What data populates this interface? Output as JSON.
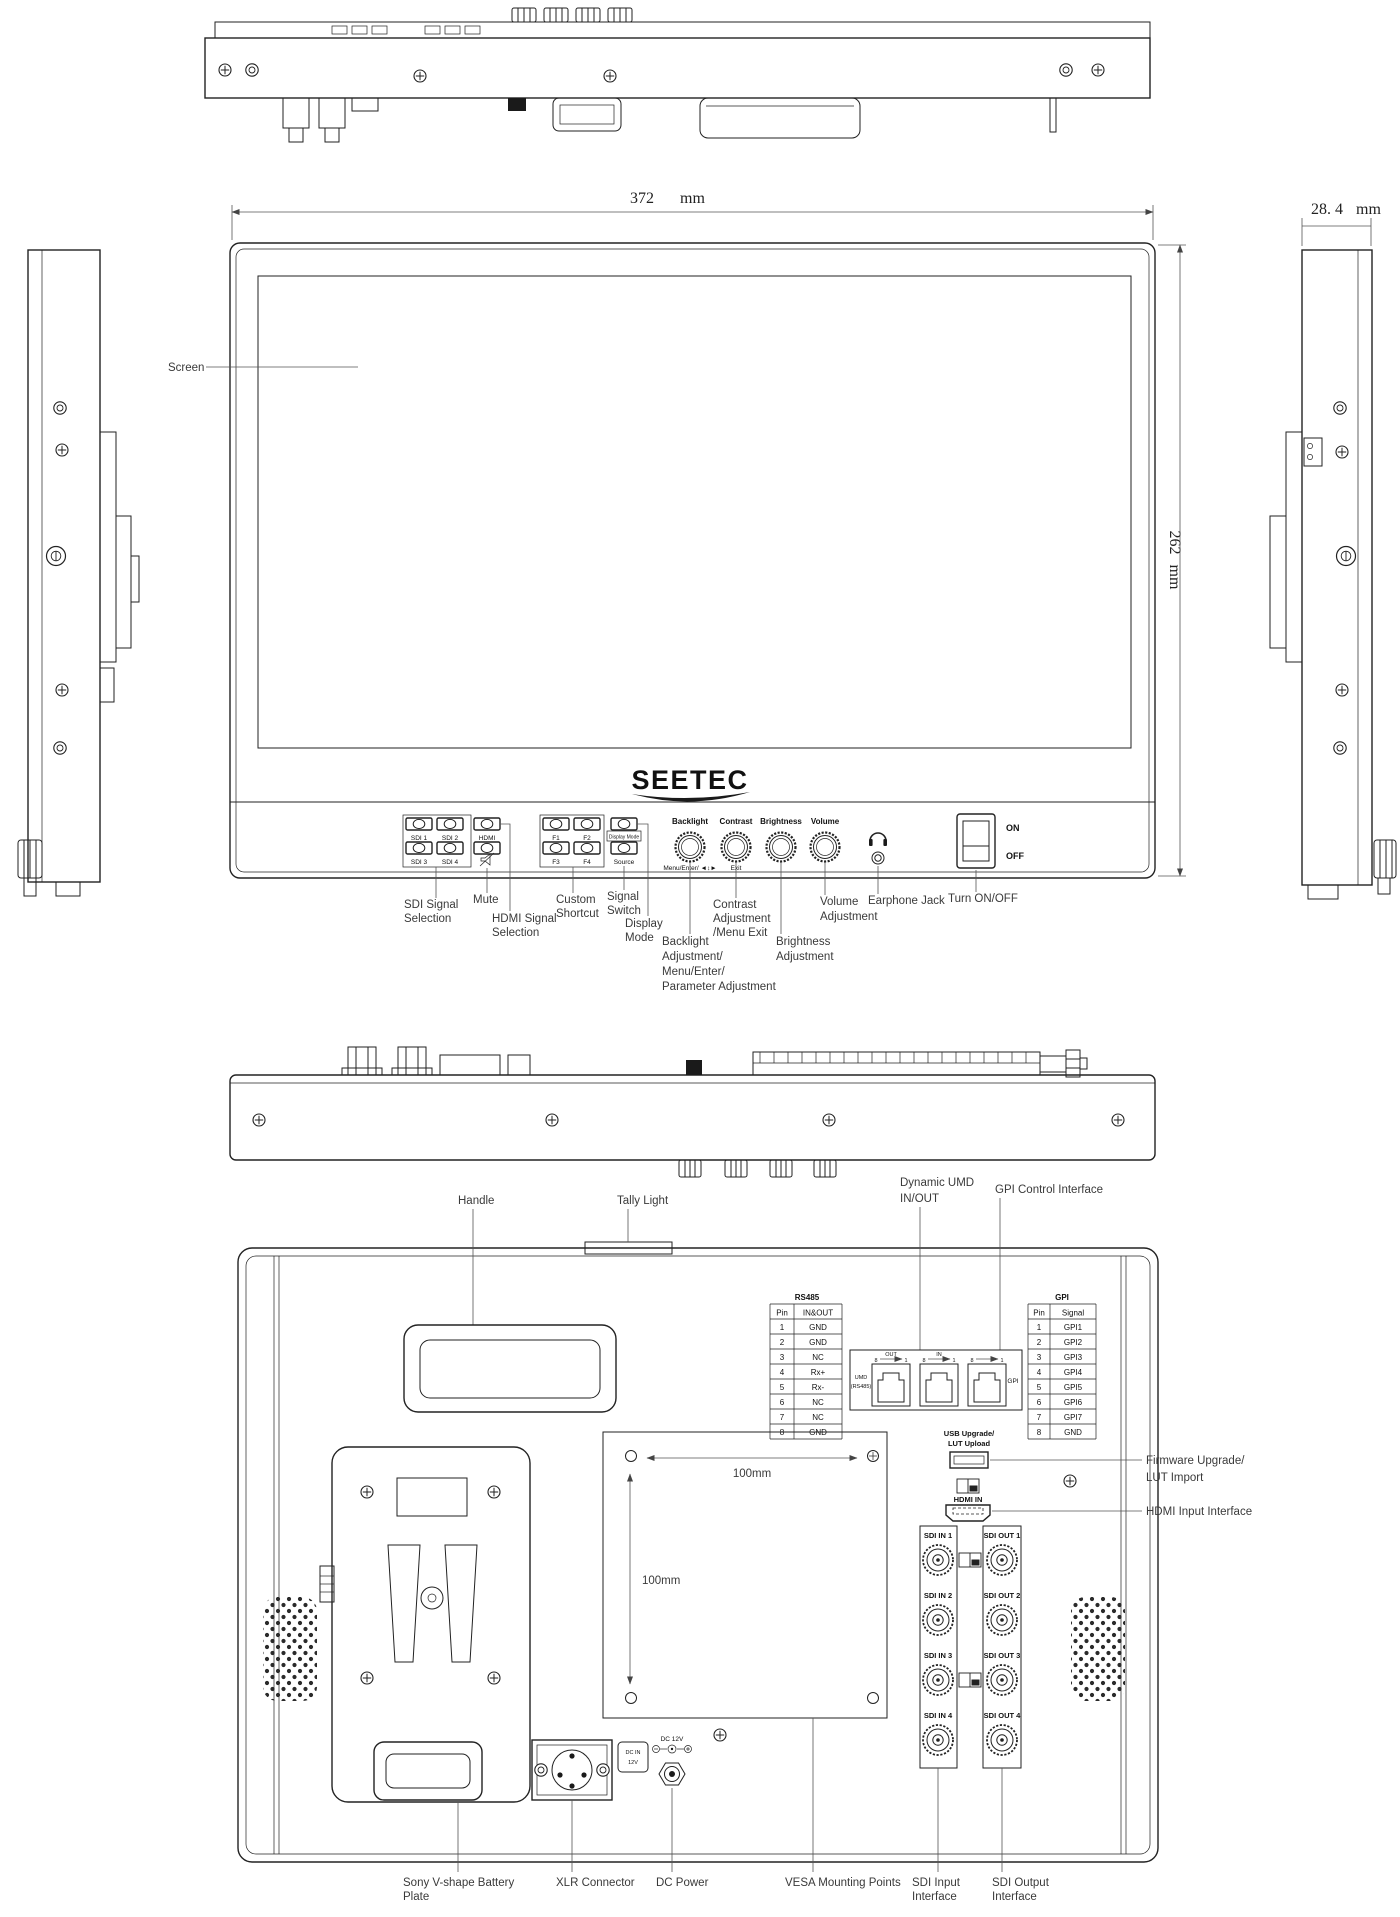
{
  "dimensions": {
    "width": "372",
    "width_unit": "mm",
    "height": "262",
    "height_unit": "mm",
    "depth": "28. 4",
    "depth_unit": "mm"
  },
  "front": {
    "logo": "SEETEC",
    "screen_callout": "Screen",
    "buttons": {
      "sdi1": "SDI 1",
      "sdi2": "SDI 2",
      "sdi3": "SDI 3",
      "sdi4": "SDI 4",
      "hdmi": "HDMI",
      "f1": "F1",
      "f2": "F2",
      "f3": "F3",
      "f4": "F4",
      "display_mode": "Display Mode",
      "source": "Source"
    },
    "knobs": {
      "backlight": "Backlight",
      "contrast": "Contrast",
      "brightness": "Brightness",
      "volume": "Volume",
      "menu": "Menu/Enter/ ◄↕►",
      "exit": "Exit"
    },
    "power": {
      "on": "ON",
      "off": "OFF"
    },
    "callouts": {
      "sdi_signal": [
        "SDI Signal",
        "Selection"
      ],
      "mute": "Mute",
      "hdmi_signal": [
        "HDMI Signal",
        "Selection"
      ],
      "custom": [
        "Custom",
        "Shortcut"
      ],
      "signal_switch": [
        "Signal",
        "Switch"
      ],
      "display_mode": [
        "Display",
        "Mode"
      ],
      "backlight": [
        "Backlight",
        "Adjustment/",
        "Menu/Enter/",
        " Parameter Adjustment"
      ],
      "contrast": [
        "Contrast",
        "Adjustment",
        "/Menu Exit"
      ],
      "brightness": [
        "Brightness",
        "Adjustment"
      ],
      "volume": [
        "Volume",
        "Adjustment"
      ],
      "earphone": "Earphone Jack",
      "power": "Turn ON/OFF"
    }
  },
  "back": {
    "callouts": {
      "handle": "Handle",
      "tally": "Tally Light",
      "umd": [
        "Dynamic UMD",
        "IN/OUT"
      ],
      "gpi": "GPI Control Interface",
      "firmware": [
        "Firmware Upgrade/",
        "LUT Import"
      ],
      "hdmi_in": "HDMI Input Interface",
      "vesa": "VESA Mounting Points",
      "battery": [
        "Sony V-shape Battery",
        "Plate"
      ],
      "xlr": "XLR Connector",
      "dc": "DC Power",
      "sdi_in": [
        "SDI Input",
        "Interface"
      ],
      "sdi_out": [
        "SDI Output",
        "Interface"
      ]
    },
    "rs485": {
      "title": "RS485",
      "h_pin": "Pin",
      "h_sig": "IN&OUT",
      "rows": [
        [
          "1",
          "GND"
        ],
        [
          "2",
          "GND"
        ],
        [
          "3",
          "NC"
        ],
        [
          "4",
          "Rx+"
        ],
        [
          "5",
          "Rx-"
        ],
        [
          "6",
          "NC"
        ],
        [
          "7",
          "NC"
        ],
        [
          "8",
          "GND"
        ]
      ]
    },
    "gpi": {
      "title": "GPI",
      "h_pin": "Pin",
      "h_sig": "Signal",
      "rows": [
        [
          "1",
          "GPI1"
        ],
        [
          "2",
          "GPI2"
        ],
        [
          "3",
          "GPI3"
        ],
        [
          "4",
          "GPI4"
        ],
        [
          "5",
          "GPI5"
        ],
        [
          "6",
          "GPI6"
        ],
        [
          "7",
          "GPI7"
        ],
        [
          "8",
          "GND"
        ]
      ]
    },
    "rj45": {
      "umd1": "UMD",
      "umd2": "(RS485)",
      "out": "OUT",
      "in": "IN",
      "gpi": "GPI",
      "p8": "8",
      "p1": "1"
    },
    "usb": [
      "USB Upgrade/",
      "LUT Upload"
    ],
    "hdmi_port": "HDMI IN",
    "sdi_in_labels": [
      "SDI IN 1",
      "SDI IN 2",
      "SDI IN 3",
      "SDI IN 4"
    ],
    "sdi_out_labels": [
      "SDI OUT 1",
      "SDI OUT 2",
      "SDI OUT 3",
      "SDI OUT 4"
    ],
    "vesa_h": "100mm",
    "vesa_v": "100mm",
    "dc_box": [
      "DC IN",
      "12V"
    ],
    "dc_12v": "DC 12V"
  }
}
